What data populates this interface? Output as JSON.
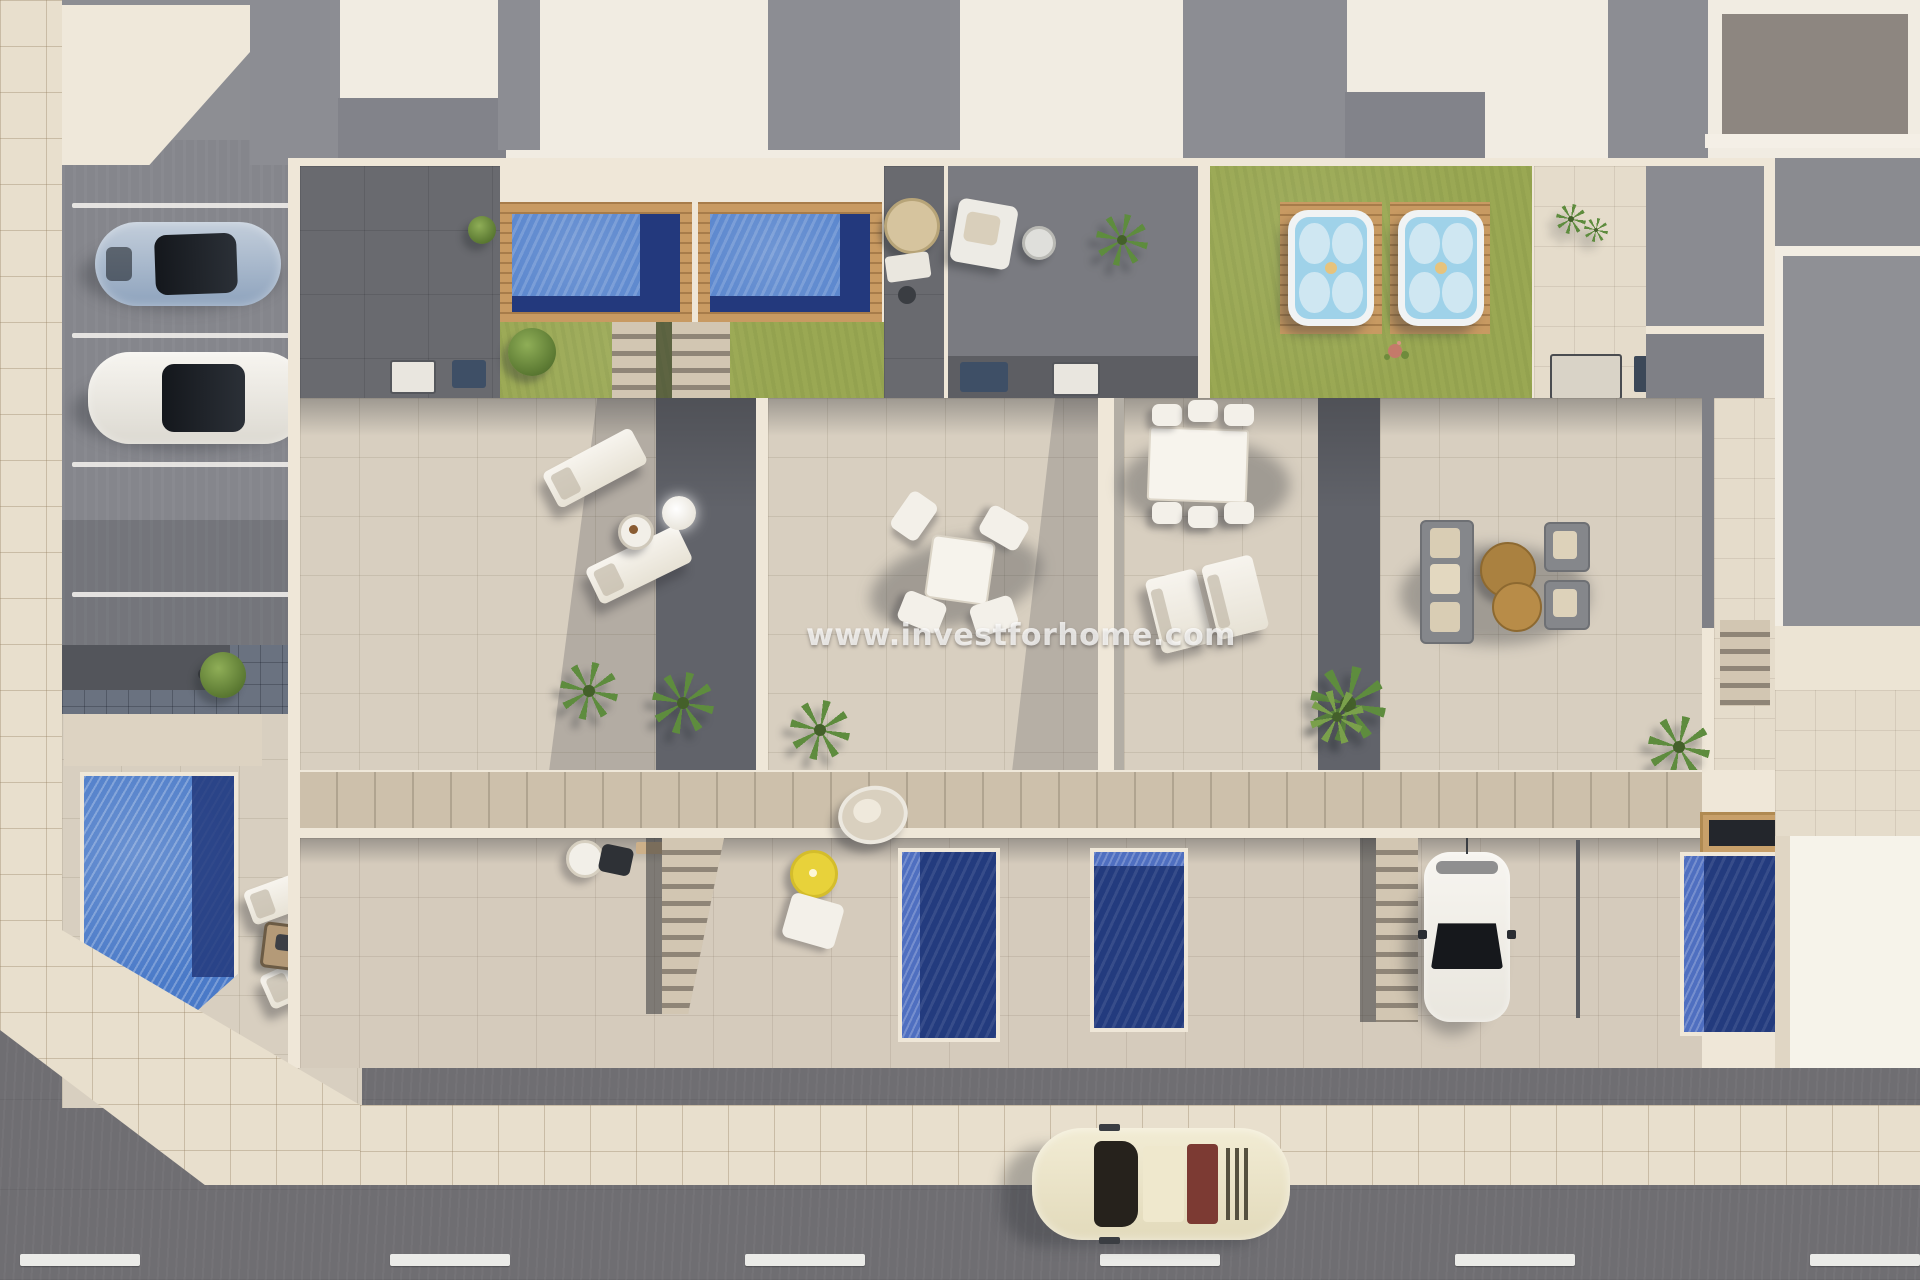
{
  "scene": {
    "type": "aerial-3d-architectural-render",
    "description": "Top-down 3D render of a row of four modern townhouses with roof terraces, rooftop pools, hot tubs, gardens, parking bays and a street",
    "watermark": {
      "text": "www.investforhome.com"
    }
  },
  "palette": {
    "road": "#6f6e72",
    "sidewalk": "#e8dfcd",
    "sidewalk_grout": "#c9bda6",
    "parking_asphalt": "#85868c",
    "wall_cream": "#efe7d8",
    "roof_white": "#f1ece2",
    "roof_gray": "#8c8d93",
    "terrace_tile": "#d8cfc0",
    "dark_patio": "#696a6f",
    "separator_shadow": "#61636a",
    "lawn_green": "#9aa853",
    "pool_light_blue": "#5b87ce",
    "pool_navy": "#23397d",
    "hot_tub_water": "#9fd2e9",
    "wood_deck": "#c89a62",
    "walkway_wood": "#cdc0ab",
    "car_silver_blue": "#9db0c6",
    "car_white": "#f3f1ec",
    "car_classic_cream": "#ece5c8",
    "parasol_yellow": "#e8d23a",
    "coffee_table_brown": "#aa8140"
  },
  "objects": {
    "vehicles": [
      {
        "name": "silver-blue-sports-car",
        "location": "parking-lot"
      },
      {
        "name": "white-sedan",
        "location": "parking-lot"
      },
      {
        "name": "white-hatchback",
        "location": "unit-4-driveway"
      },
      {
        "name": "cream-classic-car",
        "location": "street"
      }
    ],
    "water_features": [
      {
        "name": "rooftop-pool",
        "unit": 1
      },
      {
        "name": "rooftop-pool",
        "unit": 2
      },
      {
        "name": "hot-tub",
        "unit": 3
      },
      {
        "name": "hot-tub",
        "unit": 4
      },
      {
        "name": "garden-pool",
        "location": "corner-garden"
      },
      {
        "name": "garden-pool",
        "unit": 2
      },
      {
        "name": "garden-pool",
        "unit": 3
      },
      {
        "name": "garden-pool",
        "unit": 4
      }
    ],
    "furniture": [
      "sun-loungers",
      "round-side-table",
      "glow-ball-lamp",
      "square-dining-set",
      "rectangular-dining-set",
      "double-lounger",
      "lounge-sofa-set",
      "round-coffee-tables",
      "fire-pit",
      "wood-dining-table-with-wicker-chairs",
      "hanging-egg-chair",
      "yellow-parasol-table",
      "bbq-counters",
      "outdoor-kitchen"
    ],
    "landscape": [
      "lawns",
      "palm-trees",
      "round-bush",
      "flower-bed",
      "wood-pool-decks",
      "garden-stairs",
      "street-markings"
    ]
  }
}
